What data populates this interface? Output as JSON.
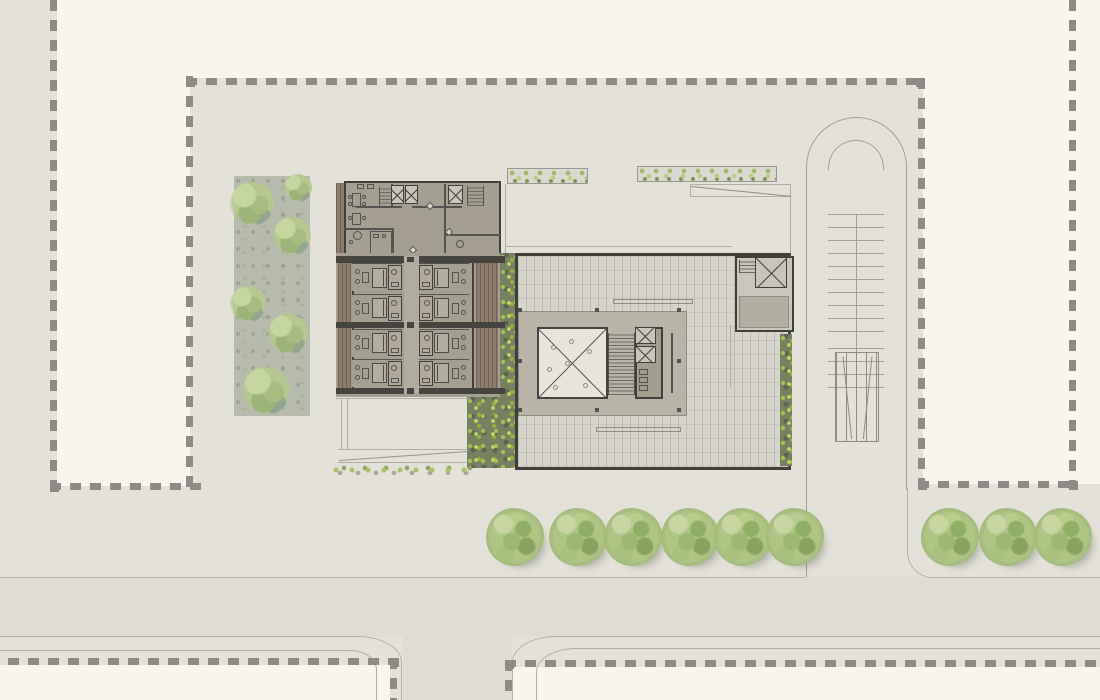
{
  "meta": {
    "title": "Architectural site plan — ground floor",
    "drawing_type": "site-plan",
    "visible_text": "none"
  },
  "palette": {
    "canvas_cream": "#f8f5ec",
    "ground": "#e3e1d8",
    "road": "#dfdcd4",
    "curb": "#b5b2aa",
    "boundary_dash": "#8e8b86",
    "wall_dark": "#403f3a",
    "floor_taupe": "#a59f92",
    "corridor": "#b2ac9f",
    "paving": "#d7d4cb",
    "slab": "#b8b5a8",
    "skylight": "#e6e4db",
    "wood": "#8d7c6a",
    "hedge_base": "#77805f",
    "hedge_bright": "#a9c254",
    "tree_green": "#aec584",
    "garden_base": "#b7bbab"
  },
  "site": {
    "boundary_style": "dashed",
    "tree_row_y": 508,
    "bottom_tree_row_x": [
      515,
      578,
      633,
      690,
      743,
      795
    ],
    "right_tree_group_x": [
      950,
      1008,
      1063
    ],
    "garden_canopies": [
      {
        "cx": 18,
        "cy": 28,
        "r": 22
      },
      {
        "cx": 58,
        "cy": 60,
        "r": 19
      },
      {
        "cx": 14,
        "cy": 128,
        "r": 18
      },
      {
        "cx": 54,
        "cy": 158,
        "r": 20
      },
      {
        "cx": 32,
        "cy": 215,
        "r": 24
      },
      {
        "cx": 64,
        "cy": 12,
        "r": 14
      }
    ]
  },
  "building": {
    "guestroom_wing": {
      "rooms_per_column": 4,
      "room_row_y": [
        263,
        293.5,
        328.5,
        358.5
      ],
      "room_columns": [
        {
          "side": "left",
          "x": 352
        },
        {
          "side": "right",
          "x": 419
        }
      ],
      "slab_band_y": [
        256,
        321.5,
        387.5
      ]
    },
    "elevator_shafts": [
      [
        391,
        185,
        13,
        19
      ],
      [
        405,
        185,
        13,
        19
      ],
      [
        448,
        185,
        15,
        19
      ],
      [
        635,
        327,
        21,
        17
      ],
      [
        635,
        346,
        21,
        17
      ],
      [
        755,
        257,
        32,
        31
      ]
    ],
    "slab_column_marks": [
      [
        518,
        308
      ],
      [
        595,
        308
      ],
      [
        677,
        308
      ],
      [
        518,
        359
      ],
      [
        677,
        359
      ],
      [
        518,
        408
      ],
      [
        595,
        408
      ],
      [
        677,
        408
      ]
    ]
  }
}
